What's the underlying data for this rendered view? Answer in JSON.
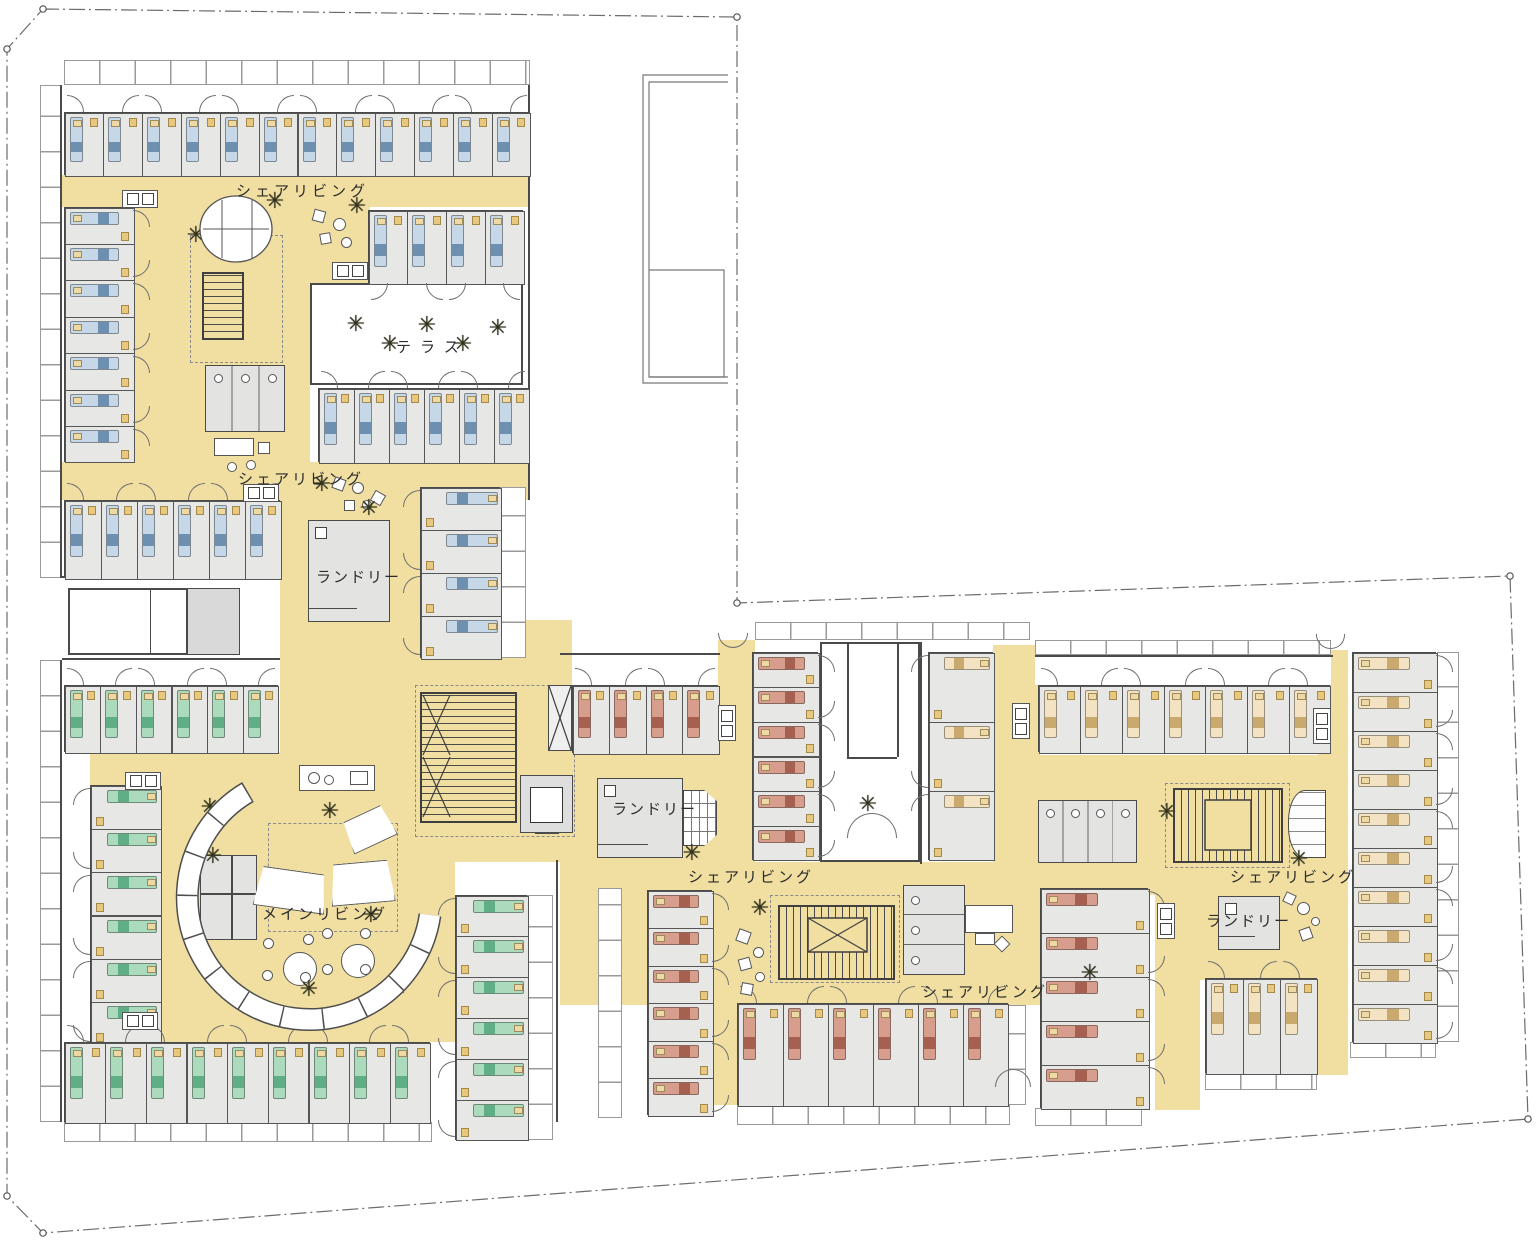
{
  "plan_title": "co-living floor plan",
  "colors": {
    "corridor": "#f1dfa2",
    "room_fill": "#e7e7e6",
    "wall": "#4a4a4a",
    "bed_blue": "#c6d8e7",
    "bed_blue_stripe": "#6d8fb0",
    "bed_green": "#abdabd",
    "bed_green_stripe": "#5fae85",
    "bed_salmon": "#d79d8d",
    "bed_salmon_stripe": "#a5604f",
    "bed_cream": "#f3e3c2",
    "bed_cream_stripe": "#c9a96e",
    "pillow": "#eed9a4"
  },
  "labels": [
    {
      "id": "share-living-1",
      "text": "シェアリビング",
      "x": 236,
      "y": 180,
      "ls": 4
    },
    {
      "id": "terrace",
      "text": "テラス",
      "x": 396,
      "y": 336,
      "ls": 9
    },
    {
      "id": "share-living-2",
      "text": "シェアリビング",
      "x": 238,
      "y": 468,
      "ls": 3
    },
    {
      "id": "laundry-1",
      "text": "ランドリー",
      "x": 316,
      "y": 566,
      "ls": 2
    },
    {
      "id": "laundry-2",
      "text": "ランドリー",
      "x": 612,
      "y": 798,
      "ls": 2
    },
    {
      "id": "share-living-3",
      "text": "シェアリビング",
      "x": 688,
      "y": 866,
      "ls": 3
    },
    {
      "id": "main-living",
      "text": "メインリビング",
      "x": 262,
      "y": 903,
      "ls": 3
    },
    {
      "id": "share-living-4",
      "text": "シェアリビング",
      "x": 922,
      "y": 981,
      "ls": 3
    },
    {
      "id": "share-living-5",
      "text": "シェアリビング",
      "x": 1230,
      "y": 866,
      "ls": 3
    },
    {
      "id": "laundry-3",
      "text": "ランドリー",
      "x": 1206,
      "y": 910,
      "ls": 2
    }
  ],
  "corridors": [
    {
      "x": 62,
      "y": 175,
      "w": 468,
      "h": 32
    },
    {
      "x": 133,
      "y": 207,
      "w": 177,
      "h": 293
    },
    {
      "x": 310,
      "y": 207,
      "w": 60,
      "h": 78
    },
    {
      "x": 62,
      "y": 462,
      "w": 468,
      "h": 38
    },
    {
      "x": 280,
      "y": 500,
      "w": 140,
      "h": 162
    },
    {
      "x": 280,
      "y": 662,
      "w": 175,
      "h": 100
    },
    {
      "x": 90,
      "y": 752,
      "w": 365,
      "h": 290
    },
    {
      "x": 420,
      "y": 620,
      "w": 152,
      "h": 242
    },
    {
      "x": 572,
      "y": 753,
      "w": 183,
      "h": 112
    },
    {
      "x": 718,
      "y": 640,
      "w": 37,
      "h": 115
    },
    {
      "x": 993,
      "y": 645,
      "w": 47,
      "h": 217
    },
    {
      "x": 560,
      "y": 862,
      "w": 480,
      "h": 143
    },
    {
      "x": 712,
      "y": 1005,
      "w": 27,
      "h": 100
    },
    {
      "x": 1035,
      "y": 755,
      "w": 313,
      "h": 140
    },
    {
      "x": 1155,
      "y": 895,
      "w": 193,
      "h": 85
    },
    {
      "x": 1318,
      "y": 650,
      "w": 30,
      "h": 425
    },
    {
      "x": 1155,
      "y": 975,
      "w": 45,
      "h": 135
    }
  ],
  "whites": [
    {
      "x": 64,
      "y": 88,
      "w": 466,
      "h": 24
    },
    {
      "x": 572,
      "y": 655,
      "w": 146,
      "h": 30
    },
    {
      "x": 1035,
      "y": 657,
      "w": 296,
      "h": 28
    },
    {
      "x": 62,
      "y": 660,
      "w": 218,
      "h": 25
    }
  ],
  "courtyard": {
    "x": 820,
    "y": 642,
    "w": 100,
    "h": 220,
    "notch_x1": 847,
    "notch_x2": 897,
    "notch_y": 757
  },
  "terrace": {
    "x": 310,
    "y": 283,
    "w": 213,
    "h": 102
  },
  "balconies": [
    {
      "x": 64,
      "y": 60,
      "w": 466,
      "h": 25
    },
    {
      "x": 40,
      "y": 85,
      "w": 22,
      "h": 493
    },
    {
      "x": 500,
      "y": 487,
      "w": 26,
      "h": 171
    },
    {
      "x": 40,
      "y": 660,
      "w": 22,
      "h": 462
    },
    {
      "x": 64,
      "y": 1122,
      "w": 368,
      "h": 20
    },
    {
      "x": 527,
      "y": 895,
      "w": 26,
      "h": 245
    },
    {
      "x": 598,
      "y": 888,
      "w": 24,
      "h": 230
    },
    {
      "x": 737,
      "y": 1105,
      "w": 273,
      "h": 20
    },
    {
      "x": 1035,
      "y": 640,
      "w": 296,
      "h": 15
    },
    {
      "x": 755,
      "y": 622,
      "w": 275,
      "h": 18
    },
    {
      "x": 1437,
      "y": 652,
      "w": 22,
      "h": 390
    },
    {
      "x": 1035,
      "y": 1108,
      "w": 107,
      "h": 18
    },
    {
      "x": 1205,
      "y": 1073,
      "w": 112,
      "h": 17
    },
    {
      "x": 1350,
      "y": 1042,
      "w": 86,
      "h": 16
    },
    {
      "x": 1008,
      "y": 1005,
      "w": 18,
      "h": 100
    }
  ],
  "walls": [
    {
      "x": 60,
      "y": 85,
      "w": 2,
      "h": 493
    },
    {
      "x": 62,
      "y": 576,
      "w": 220,
      "h": 2
    },
    {
      "x": 528,
      "y": 85,
      "w": 2,
      "h": 415
    },
    {
      "x": 60,
      "y": 660,
      "w": 2,
      "h": 462
    },
    {
      "x": 556,
      "y": 860,
      "w": 2,
      "h": 262
    },
    {
      "x": 920,
      "y": 642,
      "w": 2,
      "h": 222
    },
    {
      "x": 560,
      "y": 653,
      "w": 160,
      "h": 2
    },
    {
      "x": 1035,
      "y": 655,
      "w": 298,
      "h": 2
    },
    {
      "x": 62,
      "y": 658,
      "w": 218,
      "h": 2
    }
  ],
  "tl_court": {
    "x": 68,
    "y": 588,
    "w": 172,
    "h": 67,
    "lines": [
      150,
      186
    ]
  },
  "dashed_zones": [
    {
      "x": 190,
      "y": 235,
      "w": 93,
      "h": 128
    },
    {
      "x": 268,
      "y": 823,
      "w": 130,
      "h": 109
    },
    {
      "x": 770,
      "y": 895,
      "w": 130,
      "h": 88
    },
    {
      "x": 1165,
      "y": 783,
      "w": 125,
      "h": 85
    },
    {
      "x": 415,
      "y": 685,
      "w": 160,
      "h": 152
    }
  ],
  "strips": [
    {
      "id": "rooms-nw-top",
      "x": 64,
      "y": 112,
      "w": 466,
      "h": 63,
      "count": 12,
      "door": "up",
      "bed": "blue"
    },
    {
      "id": "rooms-nw-left",
      "x": 64,
      "y": 207,
      "w": 69,
      "h": 255,
      "count": 7,
      "door": "right",
      "bed": "blue"
    },
    {
      "id": "rooms-nw-mid",
      "x": 368,
      "y": 210,
      "w": 155,
      "h": 73,
      "count": 4,
      "door": "down",
      "bed": "blue"
    },
    {
      "id": "rooms-terrace-south",
      "x": 318,
      "y": 388,
      "w": 210,
      "h": 74,
      "count": 6,
      "door": "up",
      "bed": "blue"
    },
    {
      "id": "rooms-west-row",
      "x": 64,
      "y": 500,
      "w": 216,
      "h": 78,
      "count": 6,
      "door": "up",
      "bed": "blue"
    },
    {
      "id": "rooms-center-col",
      "x": 420,
      "y": 487,
      "w": 80,
      "h": 171,
      "count": 4,
      "door": "left",
      "bed": "blue"
    },
    {
      "id": "rooms-sw-top",
      "x": 64,
      "y": 685,
      "w": 214,
      "h": 67,
      "count": 6,
      "door": "up",
      "bed": "green"
    },
    {
      "id": "rooms-sw-left",
      "x": 90,
      "y": 785,
      "w": 70,
      "h": 260,
      "count": 6,
      "door": "left",
      "bed": "green"
    },
    {
      "id": "rooms-sw-bottom",
      "x": 64,
      "y": 1042,
      "w": 366,
      "h": 80,
      "count": 9,
      "door": "up",
      "bed": "green"
    },
    {
      "id": "rooms-sw-right",
      "x": 455,
      "y": 895,
      "w": 72,
      "h": 245,
      "count": 6,
      "door": "left",
      "bed": "green"
    },
    {
      "id": "rooms-mid-entry",
      "x": 572,
      "y": 685,
      "w": 146,
      "h": 68,
      "count": 4,
      "door": "up",
      "bed": "salmon"
    },
    {
      "id": "rooms-mid-west-col",
      "x": 752,
      "y": 652,
      "w": 66,
      "h": 208,
      "count": 6,
      "door": "right",
      "bed": "salmon"
    },
    {
      "id": "rooms-mid-east-col",
      "x": 928,
      "y": 652,
      "w": 65,
      "h": 208,
      "count": 3,
      "door": "left",
      "bed": "cream"
    },
    {
      "id": "rooms-mid-bottom",
      "x": 737,
      "y": 1003,
      "w": 271,
      "h": 102,
      "count": 6,
      "door": "up",
      "bed": "salmon"
    },
    {
      "id": "rooms-mid-left-col",
      "x": 647,
      "y": 890,
      "w": 65,
      "h": 225,
      "count": 6,
      "door": "right",
      "bed": "salmon"
    },
    {
      "id": "rooms-east-top",
      "x": 1038,
      "y": 685,
      "w": 292,
      "h": 67,
      "count": 7,
      "door": "up",
      "bed": "cream"
    },
    {
      "id": "rooms-east-west-col",
      "x": 1040,
      "y": 888,
      "w": 108,
      "h": 220,
      "count": 5,
      "door": "right",
      "bed": "salmon"
    },
    {
      "id": "rooms-east-bottom",
      "x": 1205,
      "y": 978,
      "w": 112,
      "h": 95,
      "count": 3,
      "door": "up",
      "bed": "cream"
    },
    {
      "id": "rooms-east-col",
      "x": 1352,
      "y": 652,
      "w": 84,
      "h": 390,
      "count": 10,
      "door": "right",
      "bed": "cream"
    }
  ],
  "blocks": [
    {
      "type": "laundry",
      "id": "laundry-room-1",
      "x": 308,
      "y": 520,
      "w": 82,
      "h": 102
    },
    {
      "type": "laundry",
      "id": "laundry-room-2",
      "x": 597,
      "y": 778,
      "w": 86,
      "h": 80
    },
    {
      "type": "hatch",
      "id": "laundry-machines",
      "x": 683,
      "y": 790,
      "w": 34,
      "h": 56
    },
    {
      "type": "laundry",
      "id": "laundry-room-3",
      "x": 1218,
      "y": 896,
      "w": 62,
      "h": 54
    },
    {
      "type": "toilet",
      "id": "toilets-1",
      "x": 205,
      "y": 365,
      "w": 80,
      "h": 67,
      "stalls": 3,
      "orient": "h"
    },
    {
      "type": "toilet",
      "id": "toilets-2",
      "x": 903,
      "y": 885,
      "w": 62,
      "h": 90,
      "stalls": 3,
      "orient": "v"
    },
    {
      "type": "toilet",
      "id": "toilets-3",
      "x": 1038,
      "y": 800,
      "w": 99,
      "h": 63,
      "stalls": 4,
      "orient": "h"
    },
    {
      "type": "stair",
      "id": "stair-northwest",
      "x": 202,
      "y": 272,
      "w": 42,
      "h": 68,
      "dir": "v"
    },
    {
      "type": "stair",
      "id": "stair-main",
      "x": 420,
      "y": 692,
      "w": 97,
      "h": 131,
      "dir": "v"
    },
    {
      "type": "stair",
      "id": "stair-south",
      "x": 778,
      "y": 905,
      "w": 117,
      "h": 75,
      "dir": "h"
    },
    {
      "type": "stair",
      "id": "stair-east",
      "x": 1173,
      "y": 788,
      "w": 110,
      "h": 75,
      "dir": "h"
    },
    {
      "type": "elevator",
      "id": "elevator",
      "x": 520,
      "y": 775,
      "w": 53,
      "h": 58
    },
    {
      "type": "cabinet",
      "id": "storage-cabinet",
      "x": 200,
      "y": 855,
      "w": 57,
      "h": 85
    },
    {
      "type": "closet",
      "id": "closet",
      "x": 548,
      "y": 685,
      "w": 24,
      "h": 66
    },
    {
      "type": "masonry",
      "id": "masonry-wall",
      "x": 1288,
      "y": 790,
      "w": 38,
      "h": 68
    },
    {
      "type": "graycell",
      "id": "service-cell",
      "x": 187,
      "y": 588,
      "w": 53,
      "h": 67
    },
    {
      "type": "counter",
      "id": "kitchen-counter",
      "x": 299,
      "y": 765,
      "w": 76,
      "h": 26
    }
  ],
  "entrances": [
    {
      "id": "entry-mid-north",
      "x": 718,
      "y": 633,
      "dir": "down",
      "w": 30
    },
    {
      "id": "entry-courtyard",
      "x": 847,
      "y": 838,
      "dir": "up",
      "w": 50
    },
    {
      "id": "entry-mid-south",
      "x": 995,
      "y": 1087,
      "dir": "up",
      "w": 36
    },
    {
      "id": "entry-east-north",
      "x": 1316,
      "y": 634,
      "dir": "down",
      "w": 29
    }
  ],
  "utilities": [
    {
      "x": 122,
      "y": 190,
      "dir": "h"
    },
    {
      "x": 332,
      "y": 262,
      "dir": "h"
    },
    {
      "x": 243,
      "y": 484,
      "dir": "h"
    },
    {
      "x": 125,
      "y": 772,
      "dir": "h"
    },
    {
      "x": 122,
      "y": 1012,
      "dir": "h"
    },
    {
      "x": 718,
      "y": 705,
      "dir": "v"
    },
    {
      "x": 1012,
      "y": 703,
      "dir": "v"
    },
    {
      "x": 1313,
      "y": 708,
      "dir": "v"
    },
    {
      "x": 1157,
      "y": 903,
      "dir": "v"
    }
  ],
  "furniture": [
    {
      "shape": "rect",
      "x": 313,
      "y": 210,
      "w": 12,
      "h": 12,
      "r": 15
    },
    {
      "shape": "circ",
      "x": 333,
      "y": 218,
      "w": 13
    },
    {
      "shape": "rect",
      "x": 320,
      "y": 233,
      "w": 11,
      "h": 11,
      "r": -10
    },
    {
      "shape": "circ",
      "x": 341,
      "y": 237,
      "w": 11
    },
    {
      "shape": "rect",
      "x": 333,
      "y": 478,
      "w": 12,
      "h": 12,
      "r": 20
    },
    {
      "shape": "circ",
      "x": 352,
      "y": 482,
      "w": 12
    },
    {
      "shape": "rect",
      "x": 344,
      "y": 500,
      "w": 11,
      "h": 11,
      "r": 0
    },
    {
      "shape": "circ",
      "x": 362,
      "y": 500,
      "w": 10
    },
    {
      "shape": "rect",
      "x": 372,
      "y": 492,
      "w": 12,
      "h": 12,
      "r": 30
    },
    {
      "shape": "rect",
      "x": 214,
      "y": 438,
      "w": 40,
      "h": 18,
      "r": 0
    },
    {
      "shape": "circ",
      "x": 227,
      "y": 462,
      "w": 10
    },
    {
      "shape": "circ",
      "x": 246,
      "y": 460,
      "w": 10
    },
    {
      "shape": "rect",
      "x": 258,
      "y": 442,
      "w": 12,
      "h": 12,
      "r": 0
    },
    {
      "shape": "rect",
      "x": 737,
      "y": 930,
      "w": 13,
      "h": 13,
      "r": 20
    },
    {
      "shape": "circ",
      "x": 753,
      "y": 947,
      "w": 11
    },
    {
      "shape": "rect",
      "x": 739,
      "y": 958,
      "w": 12,
      "h": 12,
      "r": -15
    },
    {
      "shape": "circ",
      "x": 755,
      "y": 972,
      "w": 10
    },
    {
      "shape": "rect",
      "x": 741,
      "y": 983,
      "w": 12,
      "h": 12,
      "r": 10
    },
    {
      "shape": "rect",
      "x": 965,
      "y": 905,
      "w": 48,
      "h": 28,
      "r": 0
    },
    {
      "shape": "rect",
      "x": 975,
      "y": 933,
      "w": 20,
      "h": 12,
      "r": 0
    },
    {
      "shape": "rect",
      "x": 996,
      "y": 938,
      "w": 12,
      "h": 12,
      "r": 45
    },
    {
      "shape": "circ",
      "x": 1297,
      "y": 902,
      "w": 13
    },
    {
      "shape": "rect",
      "x": 1284,
      "y": 893,
      "w": 11,
      "h": 11,
      "r": 25
    },
    {
      "shape": "circ",
      "x": 1311,
      "y": 917,
      "w": 9
    },
    {
      "shape": "rect",
      "x": 1300,
      "y": 928,
      "w": 12,
      "h": 12,
      "r": -20
    },
    {
      "shape": "trap",
      "x": 345,
      "y": 812,
      "w": 48,
      "h": 34,
      "r": -25
    },
    {
      "shape": "trap",
      "x": 255,
      "y": 870,
      "w": 72,
      "h": 40,
      "r": 8
    },
    {
      "shape": "trap",
      "x": 330,
      "y": 862,
      "w": 64,
      "h": 42,
      "r": -5
    },
    {
      "shape": "circ",
      "x": 283,
      "y": 952,
      "w": 34
    },
    {
      "shape": "circ",
      "x": 341,
      "y": 944,
      "w": 34
    },
    {
      "shape": "circ",
      "x": 263,
      "y": 938,
      "w": 11
    },
    {
      "shape": "circ",
      "x": 303,
      "y": 934,
      "w": 11
    },
    {
      "shape": "circ",
      "x": 262,
      "y": 970,
      "w": 11
    },
    {
      "shape": "circ",
      "x": 300,
      "y": 972,
      "w": 11
    },
    {
      "shape": "circ",
      "x": 322,
      "y": 928,
      "w": 11
    },
    {
      "shape": "circ",
      "x": 360,
      "y": 928,
      "w": 11
    },
    {
      "shape": "circ",
      "x": 322,
      "y": 964,
      "w": 11
    },
    {
      "shape": "circ",
      "x": 360,
      "y": 964,
      "w": 11
    }
  ],
  "trees": [
    {
      "x": 275,
      "y": 202
    },
    {
      "x": 357,
      "y": 207
    },
    {
      "x": 196,
      "y": 236
    },
    {
      "x": 356,
      "y": 325
    },
    {
      "x": 427,
      "y": 326
    },
    {
      "x": 498,
      "y": 329
    },
    {
      "x": 390,
      "y": 345
    },
    {
      "x": 463,
      "y": 345
    },
    {
      "x": 322,
      "y": 485
    },
    {
      "x": 369,
      "y": 509
    },
    {
      "x": 210,
      "y": 808
    },
    {
      "x": 330,
      "y": 812
    },
    {
      "x": 213,
      "y": 857
    },
    {
      "x": 203,
      "y": 966
    },
    {
      "x": 309,
      "y": 990
    },
    {
      "x": 398,
      "y": 989
    },
    {
      "x": 371,
      "y": 916
    },
    {
      "x": 692,
      "y": 854
    },
    {
      "x": 760,
      "y": 909
    },
    {
      "x": 868,
      "y": 805
    },
    {
      "x": 1090,
      "y": 974
    },
    {
      "x": 1167,
      "y": 813
    },
    {
      "x": 1299,
      "y": 860
    }
  ],
  "boundary": {
    "points": [
      [
        43,
        9
      ],
      [
        737,
        17
      ],
      [
        737,
        603
      ],
      [
        1510,
        576
      ],
      [
        1528,
        1119
      ],
      [
        43,
        1233
      ],
      [
        7,
        1196
      ],
      [
        7,
        49
      ]
    ],
    "dots": [
      [
        43,
        9
      ],
      [
        737,
        17
      ],
      [
        737,
        603
      ],
      [
        1510,
        576
      ],
      [
        1528,
        1119
      ],
      [
        43,
        1233
      ],
      [
        7,
        1196
      ],
      [
        7,
        49
      ]
    ]
  },
  "structure_lines": [
    [
      728,
      75,
      643,
      75,
      643,
      383,
      728,
      383
    ],
    [
      728,
      82,
      649,
      82,
      649,
      377,
      728,
      377
    ],
    [
      649,
      270,
      724,
      270,
      724,
      377,
      649,
      377
    ]
  ],
  "bench": {
    "path": "M 248 792 A 122 122 0 1 0 430 915"
  },
  "oval": {
    "cx": 236,
    "cy": 229,
    "rx": 36,
    "ry": 33,
    "lines_x": [
      222,
      252
    ]
  },
  "xmarks": [
    {
      "x": 423,
      "y": 695,
      "w": 27,
      "h": 60
    },
    {
      "x": 423,
      "y": 757,
      "w": 27,
      "h": 60
    },
    {
      "x": 808,
      "y": 918,
      "w": 59,
      "h": 34
    },
    {
      "x": 549,
      "y": 686,
      "w": 22,
      "h": 64
    }
  ],
  "inner_rects": [
    {
      "x": 808,
      "y": 918,
      "w": 59,
      "h": 34
    },
    {
      "x": 1205,
      "y": 800,
      "w": 46,
      "h": 50
    }
  ]
}
